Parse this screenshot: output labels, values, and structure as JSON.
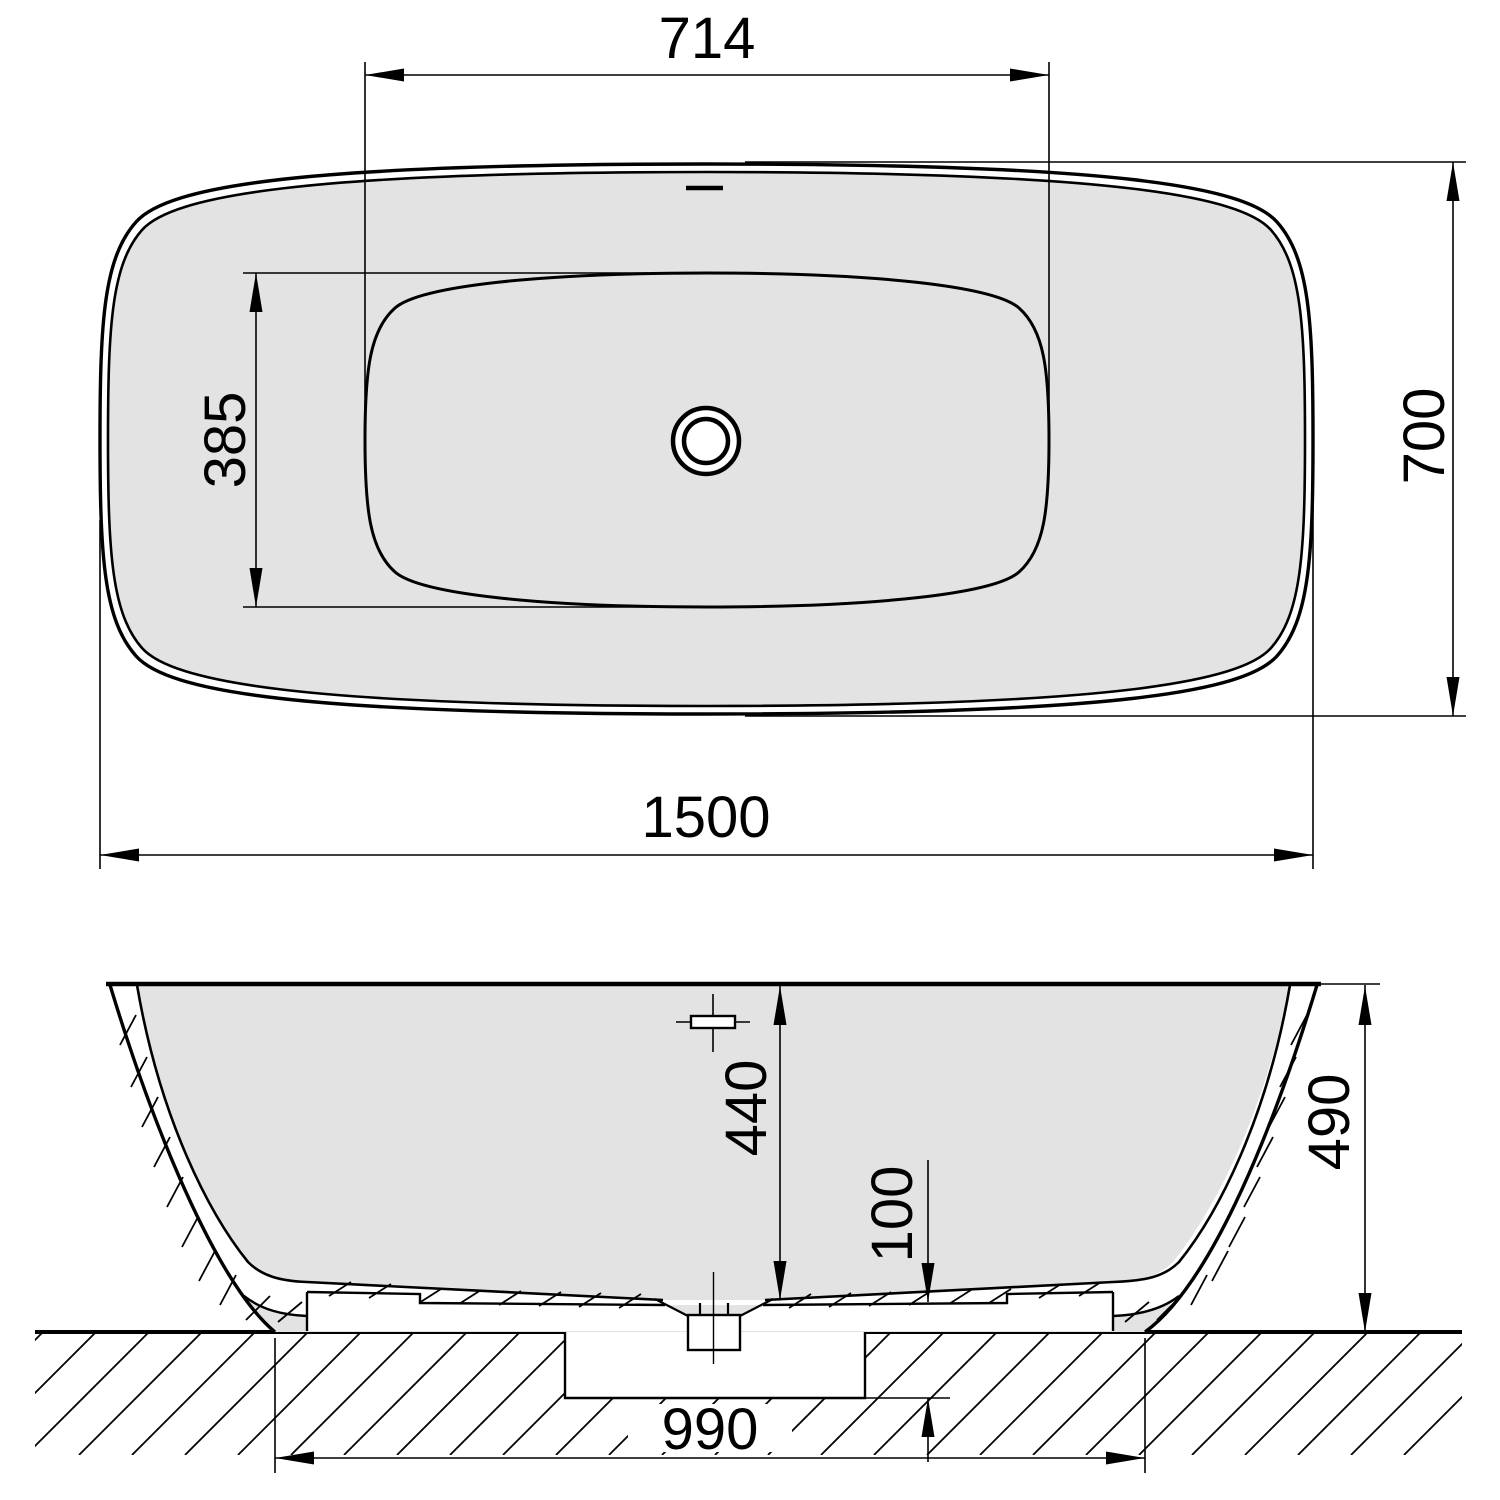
{
  "drawing": {
    "title": "Freestanding bathtub dimensional drawing",
    "units": "mm",
    "colors": {
      "body_fill": "#e3e3e3",
      "line": "#000000",
      "background": "#ffffff"
    },
    "top_view": {
      "name": "top view",
      "dims": {
        "interior_length": "714",
        "interior_width": "385",
        "overall_length": "1500",
        "overall_width": "700"
      }
    },
    "front_view": {
      "name": "front elevation",
      "dims": {
        "interior_depth": "440",
        "recess_depth": "100",
        "overall_height": "490",
        "base_span": "990"
      }
    }
  }
}
